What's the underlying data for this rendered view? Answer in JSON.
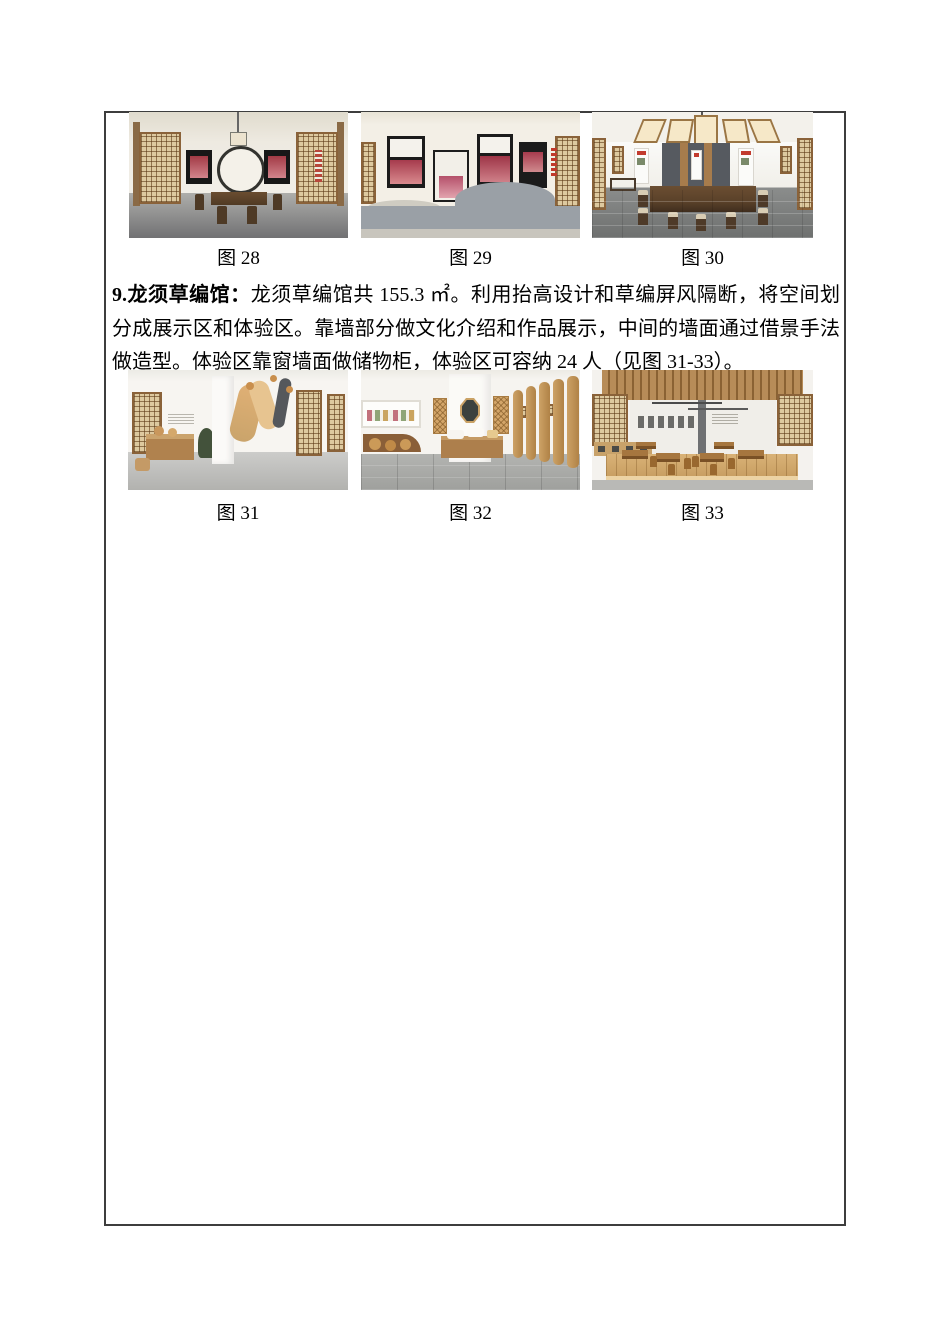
{
  "document": {
    "figures_row_1": [
      {
        "caption": "图 28",
        "alt": "展厅效果图：中式房间、木格栅门、圆形月洞造型墙、深色木桌椅"
      },
      {
        "caption": "图 29",
        "alt": "文化展示墙效果图：深色展板、红色照片与灰砖波浪造型墙"
      },
      {
        "caption": "图 30",
        "alt": "阅览室效果图：长木桌椅、深灰展墙立柱与木格栅门"
      }
    ],
    "paragraph": {
      "lead": "9.龙须草编馆：",
      "body": "龙须草编馆共 155.3 ㎡。利用抬高设计和草编屏风隔断，将空间划分成展示区和体验区。靠墙部分做文化介绍和作品展示，中间的墙面通过借景手法做造型。体验区靠窗墙面做储物柜，体验区可容纳 24 人（见图 31-33）。"
    },
    "figures_row_2": [
      {
        "caption": "图 31",
        "alt": "龙须草编馆展示区效果图：悬挂草编装置与木质展柜"
      },
      {
        "caption": "图 32",
        "alt": "龙须草编馆展示区效果图：中部造型墙、八角镜与草编屏风"
      },
      {
        "caption": "图 33",
        "alt": "龙须草编馆体验区效果图：抬高木地台与木桌椅"
      }
    ]
  }
}
